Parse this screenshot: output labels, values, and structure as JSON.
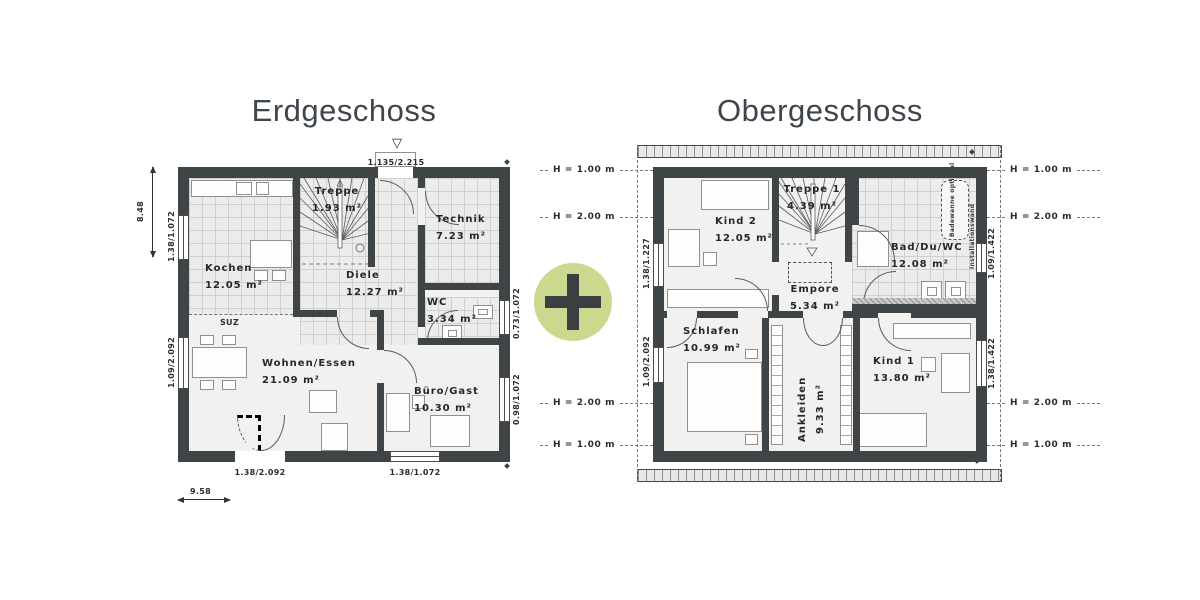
{
  "colors": {
    "accent_green": "#cbd88e",
    "wall_dark": "#3f4447"
  },
  "plus_symbol": "+",
  "erdgeschoss": {
    "title": "Erdgeschoss",
    "rooms": {
      "kochen": {
        "name": "Kochen",
        "area": "12.05 m²"
      },
      "treppe": {
        "name": "Treppe",
        "area": "1.93 m²"
      },
      "technik": {
        "name": "Technik",
        "area": "7.23 m²"
      },
      "diele": {
        "name": "Diele",
        "area": "12.27 m²"
      },
      "wc": {
        "name": "WC",
        "area": "3.34 m²"
      },
      "wohnen": {
        "name": "Wohnen/Essen",
        "area": "21.09 m²"
      },
      "buero": {
        "name": "Büro/Gast",
        "area": "10.30 m²"
      }
    },
    "dimensions": {
      "total_depth": "8.48",
      "total_width": "9.58",
      "entry_door": "1.135/2.215",
      "window_left_top": "1.38/1.072",
      "window_left_bottom": "1.09/2.092",
      "window_right_top": "0.73/1.072",
      "window_right_bottom": "0.98/1.072",
      "door_bottom": "1.38/2.092",
      "window_bottom": "1.38/1.072"
    },
    "annotations": {
      "suz": "SUZ"
    }
  },
  "obergeschoss": {
    "title": "Obergeschoss",
    "rooms": {
      "kind2": {
        "name": "Kind 2",
        "area": "12.05 m²"
      },
      "treppe1": {
        "name": "Treppe 1",
        "area": "4.39 m²"
      },
      "bad": {
        "name": "Bad/Du/WC",
        "area": "12.08 m²"
      },
      "empore": {
        "name": "Empore",
        "area": "5.34 m²"
      },
      "schlafen": {
        "name": "Schlafen",
        "area": "10.99 m²"
      },
      "ankleiden": {
        "name": "Ankleiden",
        "area": "9.33 m²"
      },
      "kind1": {
        "name": "Kind 1",
        "area": "13.80 m²"
      }
    },
    "dimensions": {
      "window_left_top": "1.38/1.227",
      "window_left_bottom": "1.09/2.092",
      "window_right_top": "1.09/1.422",
      "window_right_bottom": "1.38/1.422"
    },
    "height_labels": {
      "h100": "H = 1.00 m",
      "h200": "H = 2.00 m"
    },
    "annotations": {
      "bathtub": "Badewanne optional",
      "installation_wall": "Installationswand"
    }
  }
}
